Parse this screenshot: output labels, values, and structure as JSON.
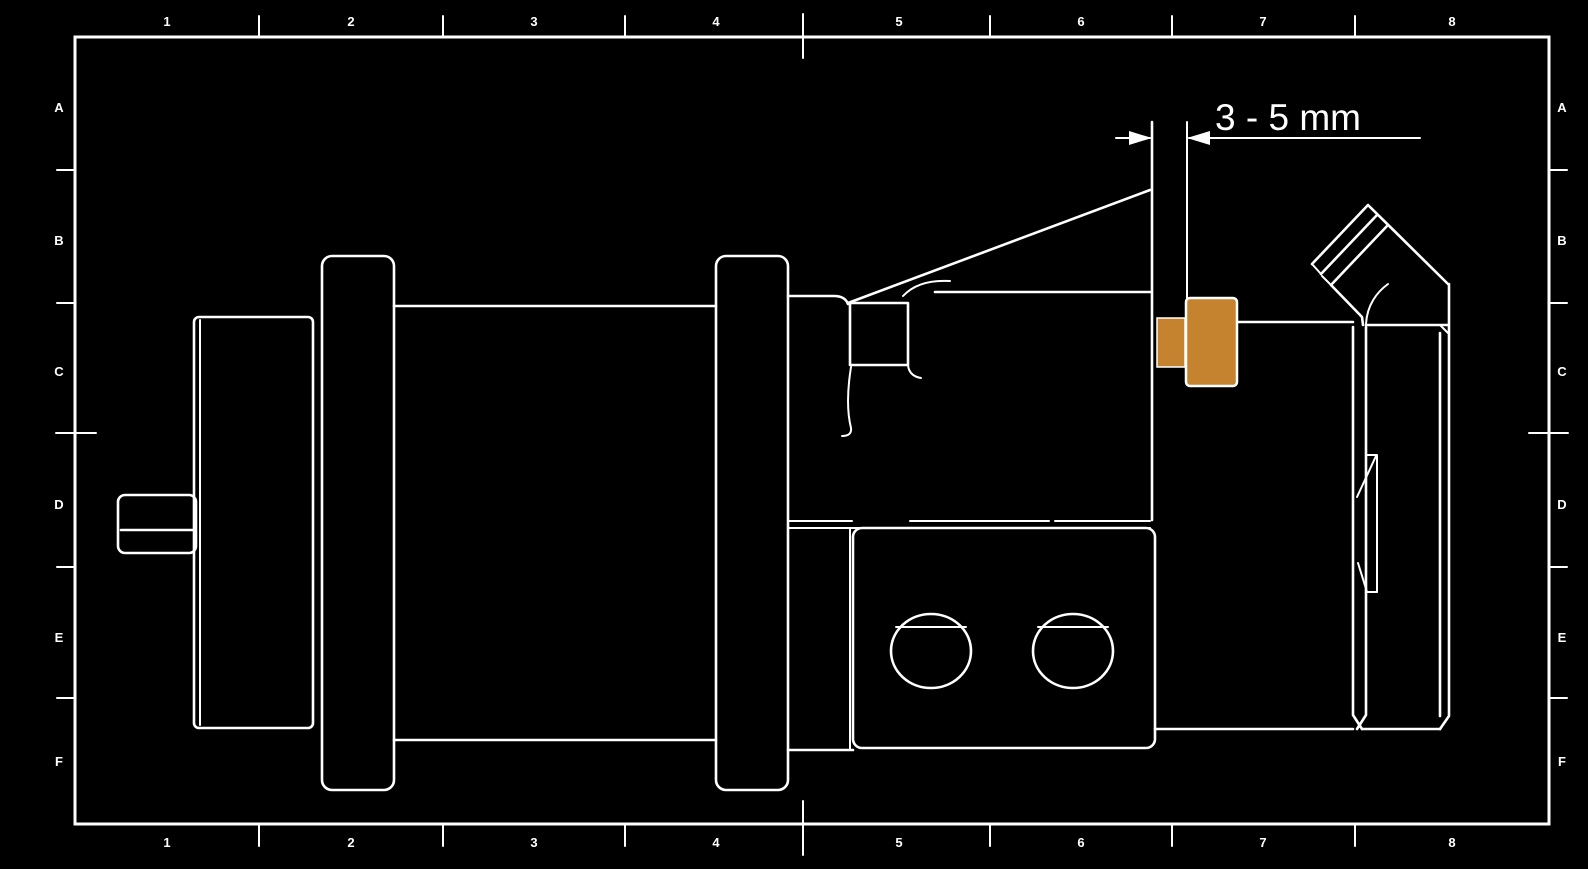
{
  "page": {
    "background_color": "#000000",
    "line_color": "#ffffff"
  },
  "grid_reference": {
    "columns": [
      "1",
      "2",
      "3",
      "4",
      "5",
      "6",
      "7",
      "8"
    ],
    "rows": [
      "A",
      "B",
      "C",
      "D",
      "E",
      "F"
    ]
  },
  "dimension": {
    "label": "3 - 5 mm"
  },
  "highlight": {
    "name": "electrode-stickout-part",
    "color": "#c6832f"
  }
}
